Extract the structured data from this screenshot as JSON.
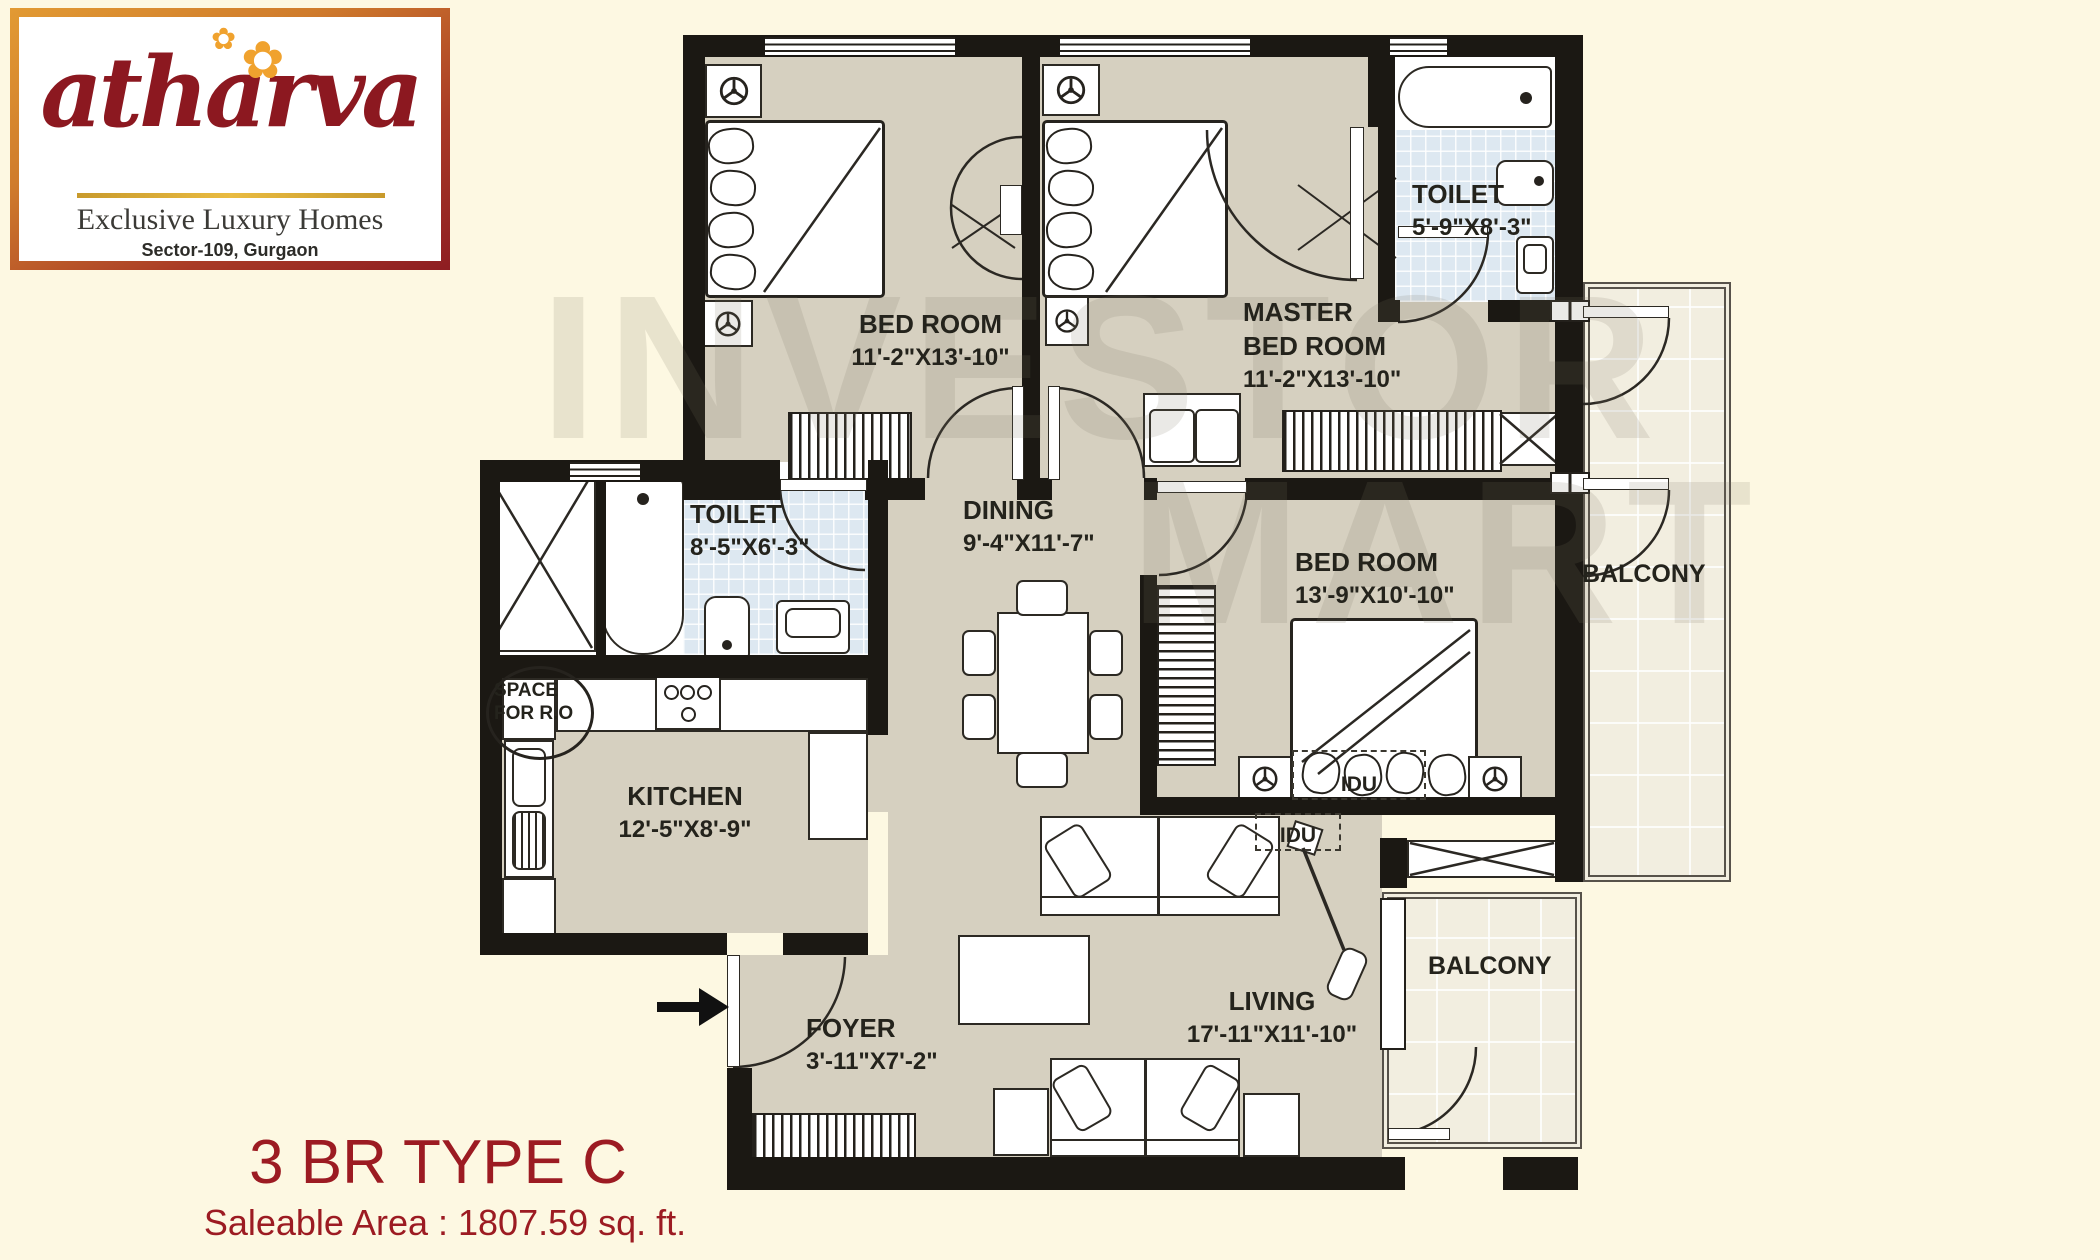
{
  "logo": {
    "brand": "atharva",
    "flower_small": "✿",
    "flower_large": "✿",
    "tagline": "Exclusive Luxury Homes",
    "location": "Sector-109, Gurgaon"
  },
  "title": {
    "plan_type": "3 BR TYPE C",
    "saleable_area": "Saleable Area : 1807.59 sq. ft."
  },
  "watermark": {
    "line1": "INVESTOR",
    "line2": "MART"
  },
  "rooms": {
    "bedroom1": {
      "name": "BED ROOM",
      "dims": "11'-2\"X13'-10\""
    },
    "master_bedroom": {
      "name_line1": "MASTER",
      "name_line2": "BED ROOM",
      "dims": "11'-2\"X13'-10\""
    },
    "toilet_top": {
      "name": "TOILET",
      "dims": "5'-9\"X8'-3\""
    },
    "toilet_mid": {
      "name": "TOILET",
      "dims": "8'-5\"X6'-3\""
    },
    "dining": {
      "name": "DINING",
      "dims": "9'-4\"X11'-7\""
    },
    "bedroom3": {
      "name": "BED ROOM",
      "dims": "13'-9\"X10'-10\""
    },
    "kitchen": {
      "name": "KITCHEN",
      "dims": "12'-5\"X8'-9\""
    },
    "foyer": {
      "name": "FOYER",
      "dims": "3'-11\"X7'-2\""
    },
    "living": {
      "name": "LIVING",
      "dims": "17'-11\"X11'-10\""
    },
    "balcony_right": {
      "name": "BALCONY"
    },
    "balcony_bottom": {
      "name": "BALCONY"
    },
    "space_ro": {
      "line1": "SPACE",
      "line2": "FOR R.O"
    },
    "idu_bed3": {
      "label": "IDU"
    },
    "idu_living": {
      "label": "IDU"
    }
  },
  "colors": {
    "background": "#fdf8e2",
    "floor": "#d6d0c0",
    "toilet_tile": "#dde8f1",
    "balcony_tile": "#f2eee0",
    "wall": "#1b1813",
    "brand_red": "#8c1820",
    "accent_gold": "#e9bb41",
    "title_red": "#9c1b22"
  }
}
